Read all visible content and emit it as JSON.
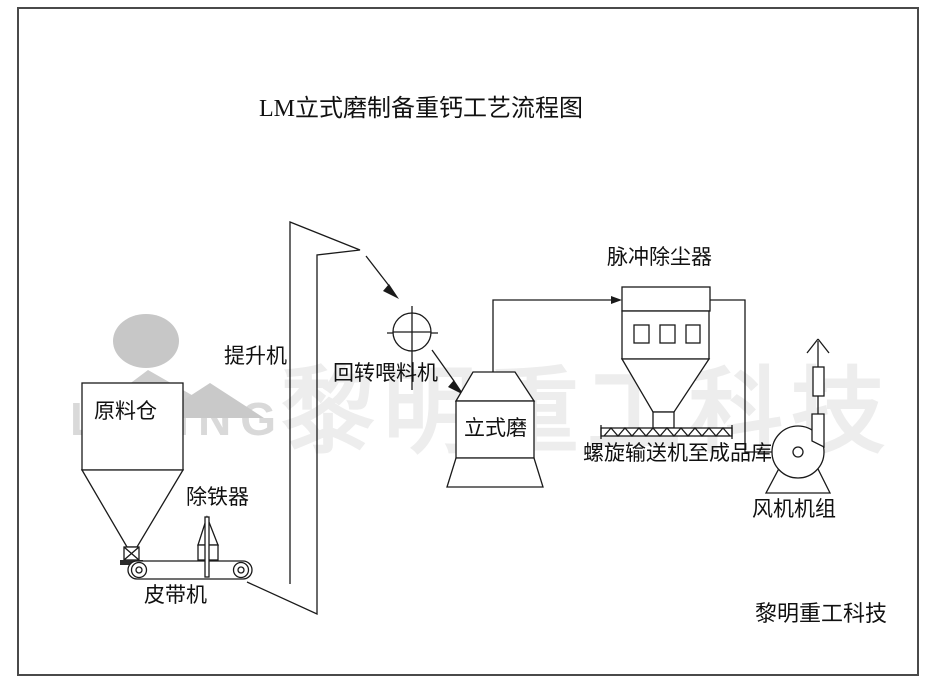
{
  "title": "LM立式磨制备重钙工艺流程图",
  "watermark": {
    "text": "黎明重工科技",
    "logo_text": "LIMING",
    "text_color": "#ededed",
    "logo_color": "#c7c7c7"
  },
  "labels": {
    "silo": "原料仓",
    "elevator": "提升机",
    "iron_remover": "除铁器",
    "belt_conveyor": "皮带机",
    "rotary_feeder": "回转喂料机",
    "vertical_mill": "立式磨",
    "dust_collector": "脉冲除尘器",
    "screw_conveyor": "螺旋输送机至成品库",
    "fan_unit": "风机机组"
  },
  "footer": {
    "company": "黎明重工科技"
  },
  "colors": {
    "line": "#1a1a1a",
    "background": "#ffffff",
    "frame": "#4a4a4a"
  }
}
